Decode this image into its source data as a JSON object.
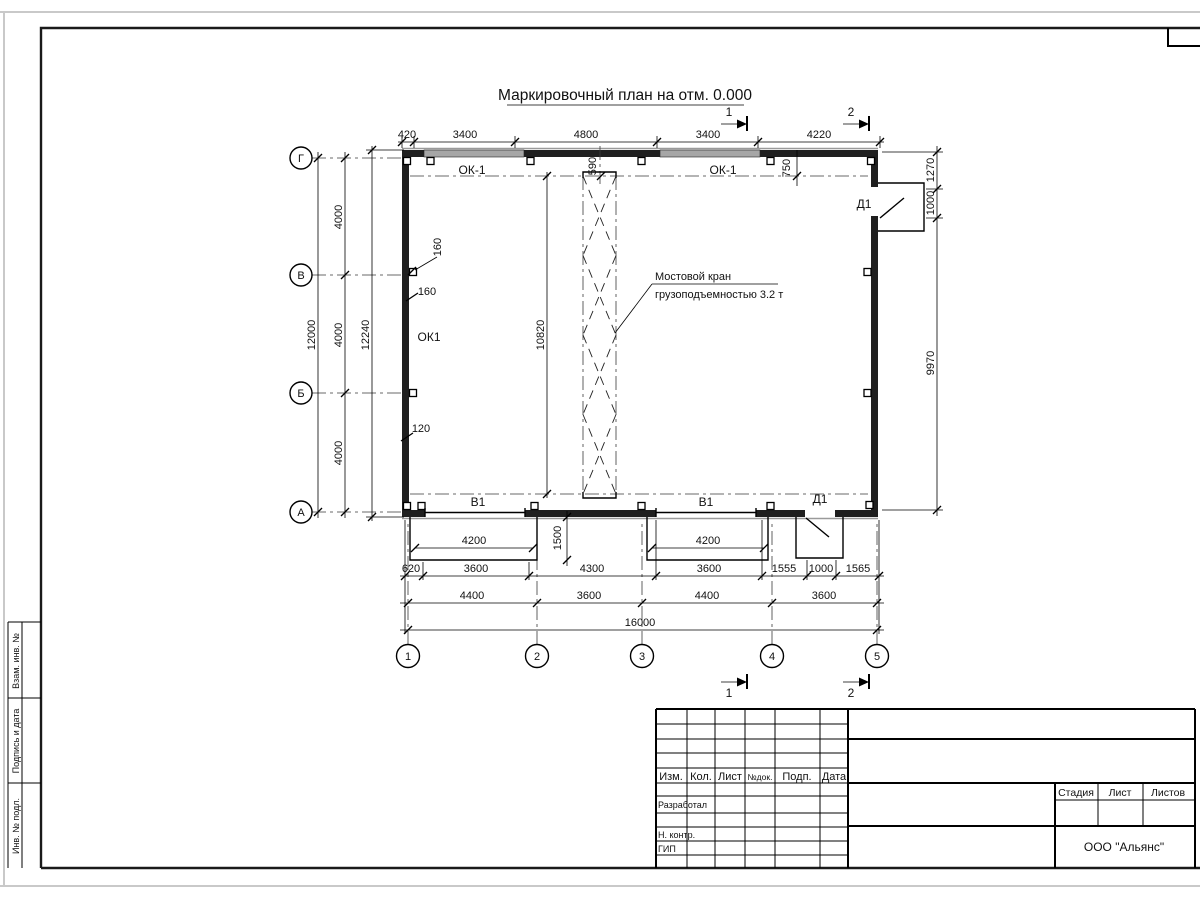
{
  "sheet": {
    "title": "Маркировочный план на отм. 0.000"
  },
  "axes": {
    "rows": [
      "Г",
      "В",
      "Б",
      "А"
    ],
    "cols": [
      "1",
      "2",
      "3",
      "4",
      "5"
    ]
  },
  "sections": {
    "s1": "1",
    "s2": "2"
  },
  "dims": {
    "top": [
      "420",
      "3400",
      "4800",
      "3400",
      "4220"
    ],
    "left_spans": [
      "4000",
      "4000",
      "4000"
    ],
    "left_total": "12000",
    "left_overall": "12240",
    "right": [
      "1270",
      "1000",
      "9970"
    ],
    "bottom_row1": [
      "620",
      "3600",
      "4300",
      "3600",
      "1555",
      "1000",
      "1565"
    ],
    "bottom_row2": [
      "4400",
      "3600",
      "4400",
      "3600"
    ],
    "bottom_total": "16000",
    "crane_span": "10820",
    "offset_590": "590",
    "offset_750": "750",
    "wall_160a": "160",
    "wall_160b": "160",
    "wall_120": "120",
    "gate_a_width": "4200",
    "gate_b_width": "4200",
    "ramp_depth": "1500"
  },
  "marks": {
    "window_a": "ОК-1",
    "window_b": "ОК-1",
    "window_left": "ОК1",
    "gate_a": "В1",
    "gate_b": "В1",
    "door_top": "Д1",
    "door_bottom": "Д1"
  },
  "note": {
    "line1": "Мостовой кран",
    "line2": "грузоподъемностью 3.2 т"
  },
  "titleblock": {
    "cols": [
      "Изм.",
      "Кол.",
      "Лист",
      "№док.",
      "Подп.",
      "Дата"
    ],
    "row_developer": "Разработал",
    "row_ncontr": "Н. контр.",
    "row_gip": "ГИП",
    "stage": "Стадия",
    "sheet": "Лист",
    "sheets": "Листов",
    "company": "ООО \"Альянс\""
  },
  "margin": {
    "vzam": "Взам. инв. №",
    "podpis": "Подпись и дата",
    "inv": "Инв. № подл."
  }
}
